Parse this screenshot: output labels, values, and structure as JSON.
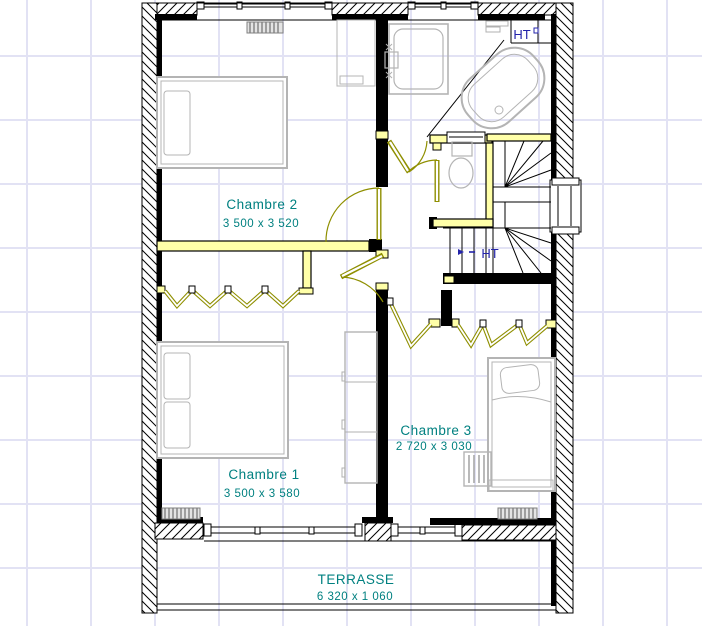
{
  "plan": {
    "type": "architectural-floor-plan",
    "rooms": [
      {
        "name": "Chambre 2",
        "dims": "3 500 x 3 520"
      },
      {
        "name": "Chambre 1",
        "dims": "3 500 x 3 580"
      },
      {
        "name": "Chambre 3",
        "dims": "2 720 x 3 030"
      },
      {
        "name": "TERRASSE",
        "dims": "6 320 x 1 060"
      }
    ],
    "annotations": {
      "ht_upper": "HT",
      "ht_stairs": "HT"
    },
    "colors": {
      "label_teal": "#008080",
      "annotation_navy": "#2323aa",
      "door_olive": "#8f8f00",
      "partition_yellow": "#ffffa8",
      "grid_lavender": "#e2e2f4",
      "furniture_gray": "#b4b4b4",
      "wall_black": "#000000"
    }
  }
}
